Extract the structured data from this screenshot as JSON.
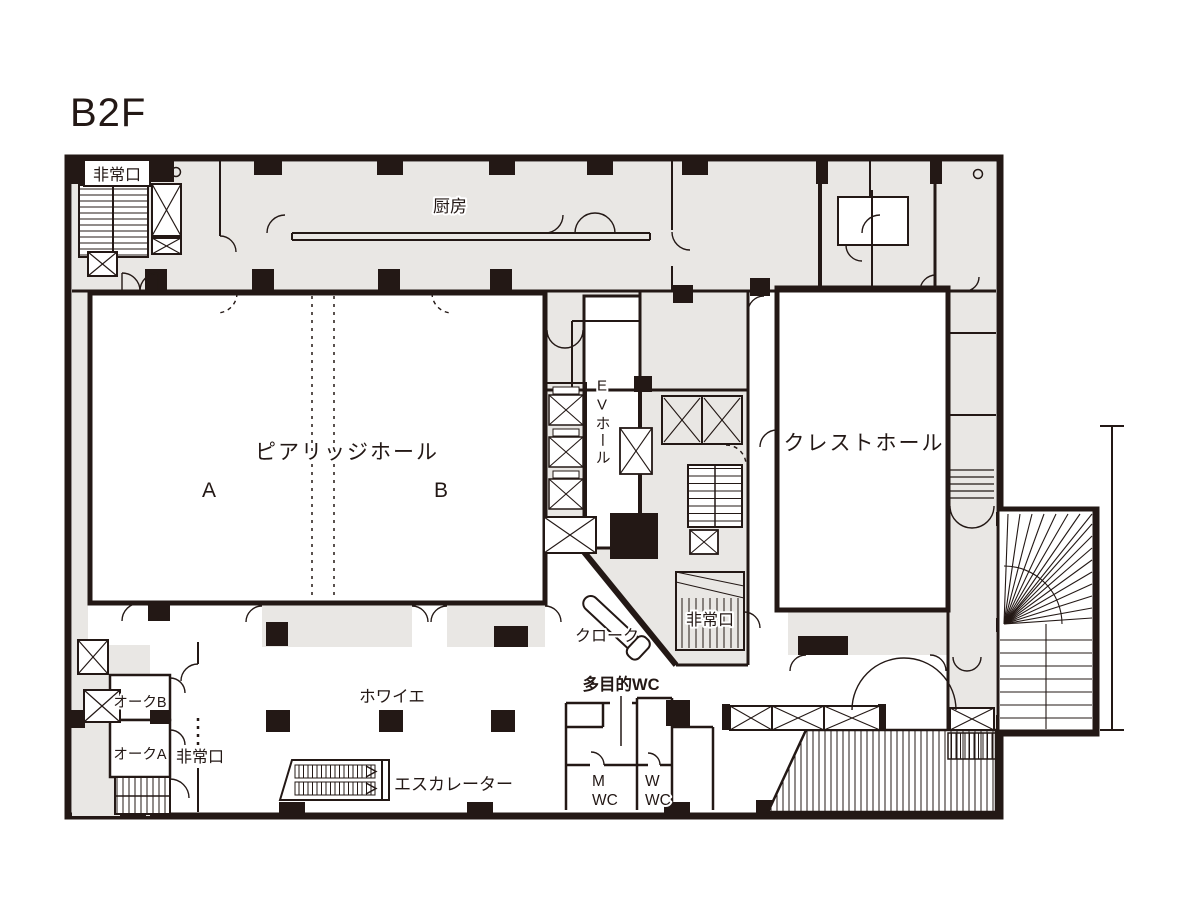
{
  "title": "B2F",
  "colors": {
    "line": "#231815",
    "area_fill": "#e9e7e4",
    "room_fill": "#ffffff"
  },
  "labels": {
    "exit_top_left": "非常口",
    "kitchen": "厨房",
    "pia_ridge_hall": "ピアリッジホール",
    "hall_a": "A",
    "hall_b": "B",
    "ev_hall": "EVホール",
    "crest_hall": "クレストホール",
    "exit_center": "非常口",
    "cloak": "クローク",
    "multipurpose_wc": "多目的WC",
    "oak_b": "オークB",
    "oak_a": "オークA",
    "exit_bottom": "非常口",
    "foyer": "ホワイエ",
    "escalator": "エスカレーター",
    "mens_wc_line1": "M",
    "mens_wc_line2": "WC",
    "womens_wc_line1": "W",
    "womens_wc_line2": "WC"
  }
}
